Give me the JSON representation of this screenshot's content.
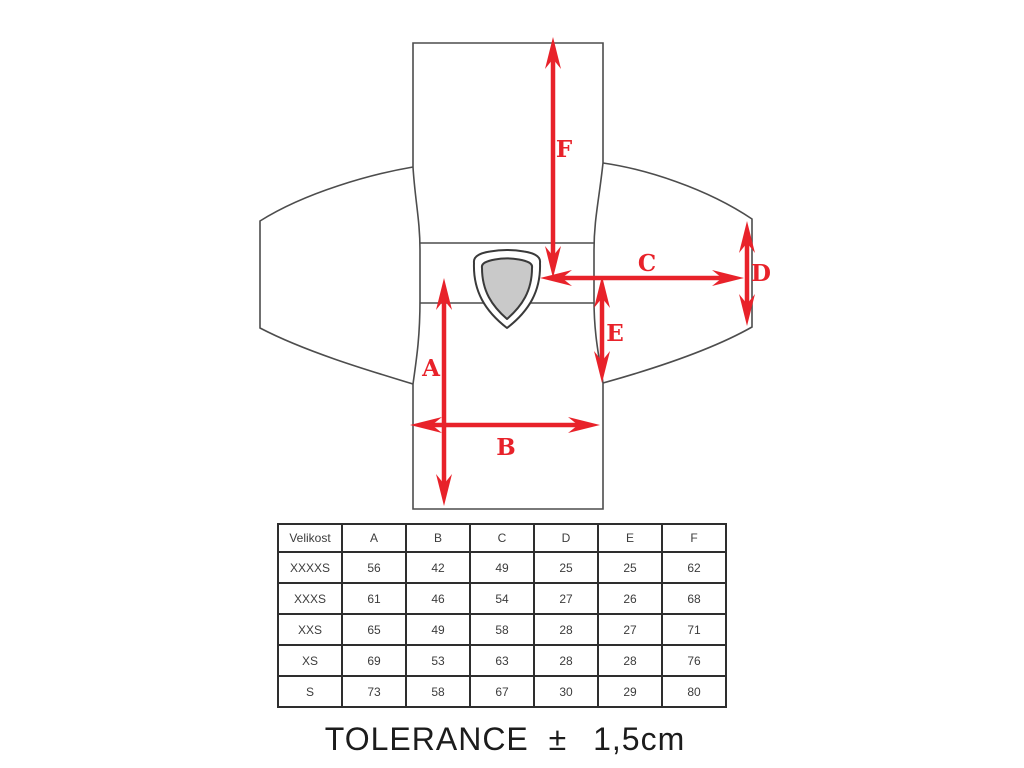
{
  "diagram": {
    "dimension_labels": {
      "a": "A",
      "b": "B",
      "c": "C",
      "d": "D",
      "e": "E",
      "f": "F"
    },
    "colors": {
      "arrow_red": "#e8222a",
      "garment_outline": "#4d4d4d",
      "shield_fill": "#c9c9c9"
    }
  },
  "size_table": {
    "header": [
      "Velikost",
      "A",
      "B",
      "C",
      "D",
      "E",
      "F"
    ],
    "rows": [
      [
        "XXXXS",
        "56",
        "42",
        "49",
        "25",
        "25",
        "62"
      ],
      [
        "XXXS",
        "61",
        "46",
        "54",
        "27",
        "26",
        "68"
      ],
      [
        "XXS",
        "65",
        "49",
        "58",
        "28",
        "27",
        "71"
      ],
      [
        "XS",
        "69",
        "53",
        "63",
        "28",
        "28",
        "76"
      ],
      [
        "S",
        "73",
        "58",
        "67",
        "30",
        "29",
        "80"
      ]
    ]
  },
  "tolerance": {
    "label": "TOLERANCE",
    "symbol": "±",
    "value": "1,5cm"
  }
}
